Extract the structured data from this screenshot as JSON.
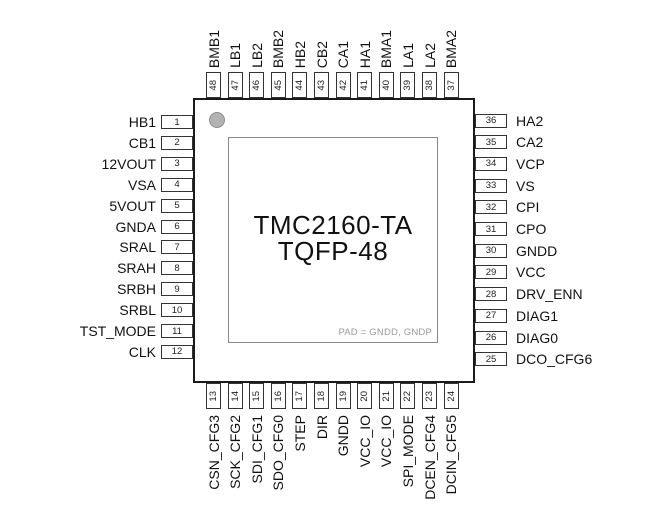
{
  "diagram": {
    "chip_name": "TMC2160-TA",
    "package": "TQFP-48",
    "pad_note": "PAD = GNDD, GNDP"
  },
  "pins": {
    "left": [
      {
        "num": "1",
        "label": "HB1"
      },
      {
        "num": "2",
        "label": "CB1"
      },
      {
        "num": "3",
        "label": "12VOUT"
      },
      {
        "num": "4",
        "label": "VSA"
      },
      {
        "num": "5",
        "label": "5VOUT"
      },
      {
        "num": "6",
        "label": "GNDA"
      },
      {
        "num": "7",
        "label": "SRAL"
      },
      {
        "num": "8",
        "label": "SRAH"
      },
      {
        "num": "9",
        "label": "SRBH"
      },
      {
        "num": "10",
        "label": "SRBL"
      },
      {
        "num": "11",
        "label": "TST_MODE"
      },
      {
        "num": "12",
        "label": "CLK"
      }
    ],
    "top": [
      {
        "num": "48",
        "label": "BMB1"
      },
      {
        "num": "47",
        "label": "LB1"
      },
      {
        "num": "46",
        "label": "LB2"
      },
      {
        "num": "45",
        "label": "BMB2"
      },
      {
        "num": "44",
        "label": "HB2"
      },
      {
        "num": "43",
        "label": "CB2"
      },
      {
        "num": "42",
        "label": "CA1"
      },
      {
        "num": "41",
        "label": "HA1"
      },
      {
        "num": "40",
        "label": "BMA1"
      },
      {
        "num": "39",
        "label": "LA1"
      },
      {
        "num": "38",
        "label": "LA2"
      },
      {
        "num": "37",
        "label": "BMA2"
      }
    ],
    "right": [
      {
        "num": "36",
        "label": "HA2"
      },
      {
        "num": "35",
        "label": "CA2"
      },
      {
        "num": "34",
        "label": "VCP"
      },
      {
        "num": "33",
        "label": "VS"
      },
      {
        "num": "32",
        "label": "CPI"
      },
      {
        "num": "31",
        "label": "CPO"
      },
      {
        "num": "30",
        "label": "GNDD"
      },
      {
        "num": "29",
        "label": "VCC"
      },
      {
        "num": "28",
        "label": "DRV_ENN"
      },
      {
        "num": "27",
        "label": "DIAG1"
      },
      {
        "num": "26",
        "label": "DIAG0"
      },
      {
        "num": "25",
        "label": "DCO_CFG6"
      }
    ],
    "bottom": [
      {
        "num": "13",
        "label": "CSN_CFG3"
      },
      {
        "num": "14",
        "label": "SCK_CFG2"
      },
      {
        "num": "15",
        "label": "SDI_CFG1"
      },
      {
        "num": "16",
        "label": "SDO_CFG0"
      },
      {
        "num": "17",
        "label": "STEP"
      },
      {
        "num": "18",
        "label": "DIR"
      },
      {
        "num": "19",
        "label": "GNDD"
      },
      {
        "num": "20",
        "label": "VCC_IO"
      },
      {
        "num": "21",
        "label": "VCC_IO"
      },
      {
        "num": "22",
        "label": "SPI_MODE"
      },
      {
        "num": "23",
        "label": "DCEN_CFG4"
      },
      {
        "num": "24",
        "label": "DCIN_CFG5"
      }
    ]
  },
  "colors": {
    "background": "#ffffff",
    "outline": "#1a1a1a",
    "box_border": "#333333",
    "inner_outline": "#888888",
    "marker_fill": "#b3b3b3",
    "pad_note": "#999999",
    "text": "#111111"
  }
}
